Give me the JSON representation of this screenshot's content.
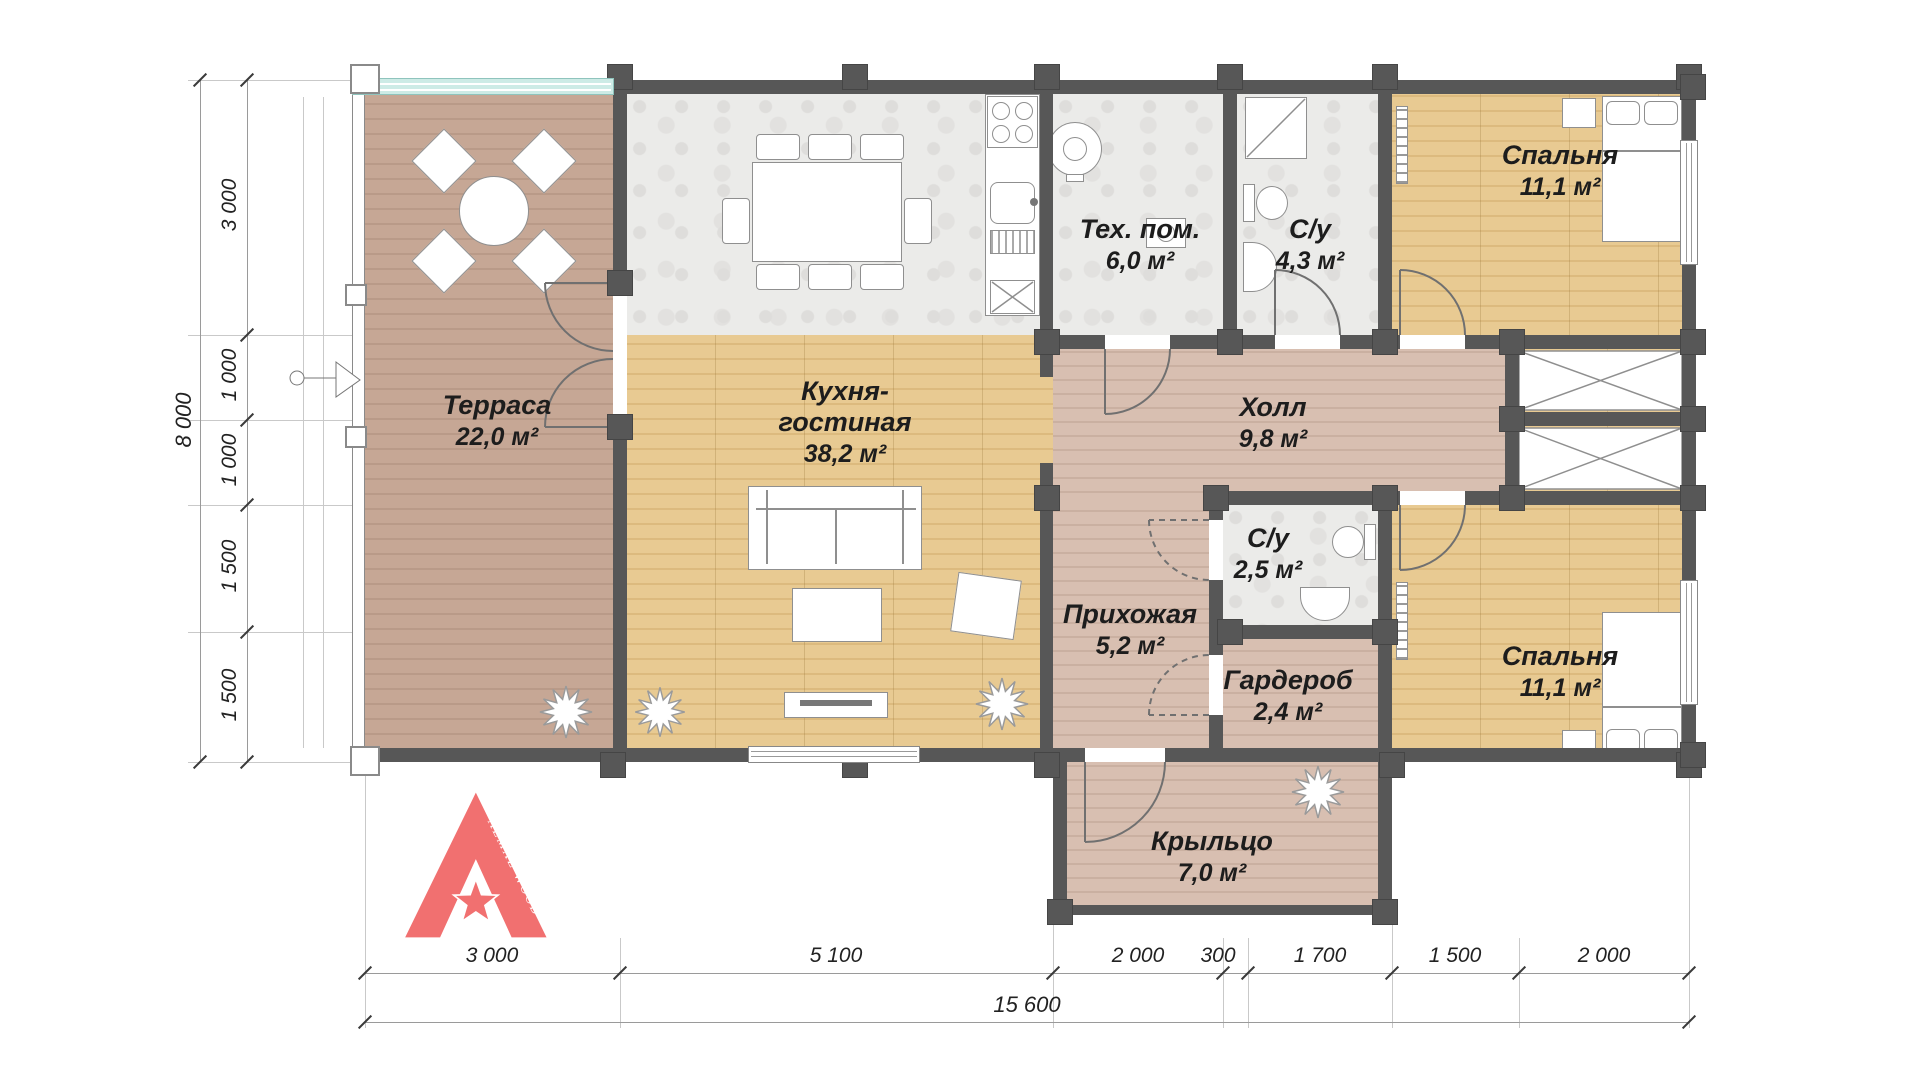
{
  "rooms": {
    "terrace": {
      "name": "Терраса",
      "area": "22,0 м²"
    },
    "kitchen_living": {
      "name": "Кухня-гостиная",
      "area": "38,2 м²"
    },
    "tech": {
      "name": "Тех. пом.",
      "area": "6,0 м²"
    },
    "bathroom_big": {
      "name": "С/у",
      "area": "4,3 м²"
    },
    "bedroom_top": {
      "name": "Спальня",
      "area": "11,1 м²"
    },
    "hall": {
      "name": "Холл",
      "area": "9,8 м²"
    },
    "bathroom_small": {
      "name": "С/у",
      "area": "2,5 м²"
    },
    "entry": {
      "name": "Прихожая",
      "area": "5,2 м²"
    },
    "wardrobe": {
      "name": "Гардероб",
      "area": "2,4 м²"
    },
    "bedroom_bottom": {
      "name": "Спальня",
      "area": "11,1 м²"
    },
    "porch": {
      "name": "Крыльцо",
      "area": "7,0 м²"
    }
  },
  "dimensions": {
    "left": {
      "overall": "8 000",
      "segments": [
        "3 000",
        "1 000",
        "1 000",
        "1 500",
        "1 500"
      ]
    },
    "bottom": {
      "overall": "15 600",
      "segments": [
        "3 000",
        "5 100",
        "2 000",
        "300",
        "1 700",
        "1 500",
        "2 000"
      ]
    }
  },
  "logo": {
    "text": "ALMAZ WOOD"
  },
  "colors": {
    "wall": "#575757",
    "logo": "#f17070",
    "glass": "#cdebe6",
    "oak_floor": "#e2c289",
    "terrace_floor": "#c0a292",
    "hall_floor": "#d1b7a9"
  }
}
